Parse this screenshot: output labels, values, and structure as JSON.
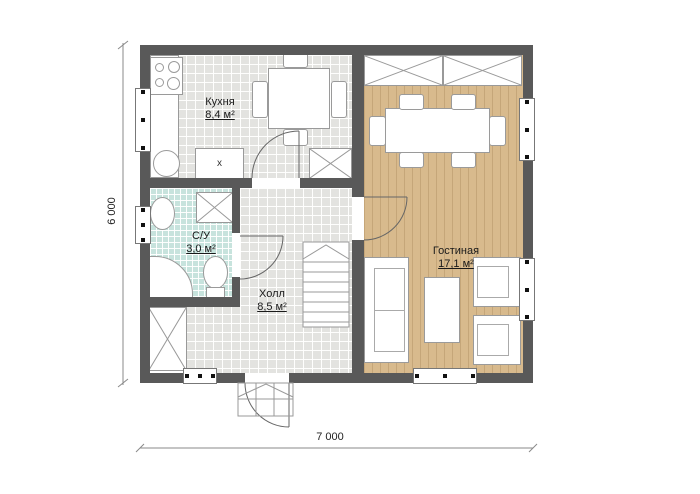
{
  "plan": {
    "title": "floor-plan-first-floor",
    "rooms": {
      "kitchen": {
        "name": "Кухня",
        "area": "8,4 м²"
      },
      "bathroom": {
        "name": "С/У",
        "area": "3,0 м²"
      },
      "hall": {
        "name": "Холл",
        "area": "8,5 м²"
      },
      "living_room": {
        "name": "Гостиная",
        "area": "17,1 м²"
      }
    },
    "dimensions": {
      "width_label": "7 000",
      "height_label": "6 000"
    },
    "marks": {
      "cabinet": "x"
    },
    "colors": {
      "wall": "#595959",
      "tile_floor": "#e3e3e0",
      "bath_floor": "#c7e3dd",
      "wood_floor": "#d8ba8d"
    }
  }
}
